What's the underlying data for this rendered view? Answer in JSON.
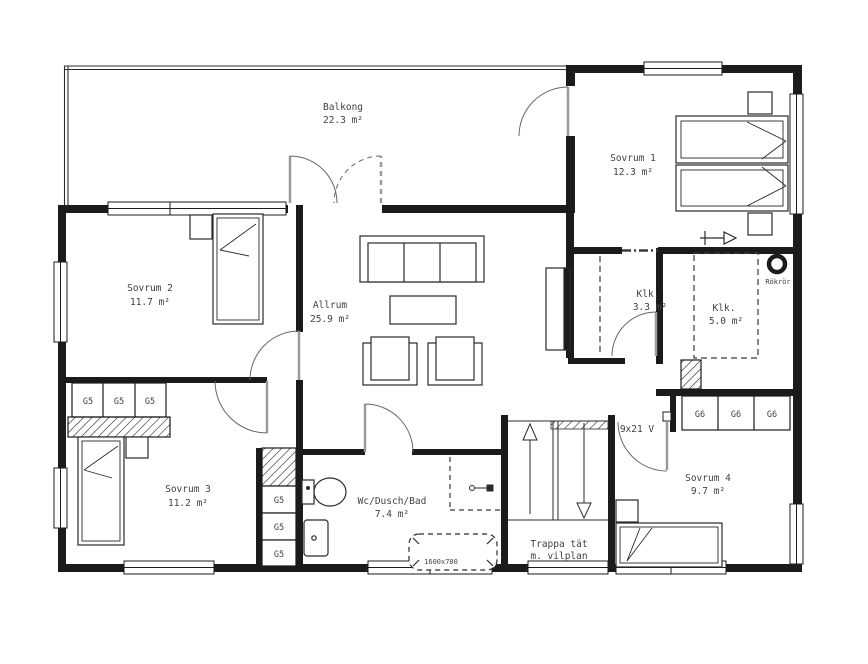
{
  "drawing": {
    "title": "Floor plan, upper storey",
    "rooms": [
      {
        "name": "Balkong",
        "area": "22.3 m²"
      },
      {
        "name": "Sovrum 1",
        "area": "12.3 m²"
      },
      {
        "name": "Sovrum 2",
        "area": "11.7 m²"
      },
      {
        "name": "Allrum",
        "area": "25.9 m²"
      },
      {
        "name": "Klk.",
        "area": "3.3 m²"
      },
      {
        "name": "Klk.",
        "area": "5.0 m²"
      },
      {
        "name": "Sovrum 3",
        "area": "11.2 m²"
      },
      {
        "name": "Wc/Dusch/Bad",
        "area": "7.4 m²"
      },
      {
        "name": "Sovrum 4",
        "area": "9.7 m²"
      }
    ],
    "stairs": {
      "line1": "Trappa tät",
      "line2": "m. vilplan"
    },
    "labels": {
      "door": "9x21 V",
      "chimney": "Rökrör",
      "bathtub": "1600x700"
    },
    "wardrobes": {
      "g5": "G5",
      "g6": "G6"
    },
    "colors": {
      "wall": "#1b1b1b",
      "line": "#2b2b2b",
      "text": "#3f3f46",
      "door_leaf": "#9a9a9a",
      "background": "#ffffff"
    }
  }
}
